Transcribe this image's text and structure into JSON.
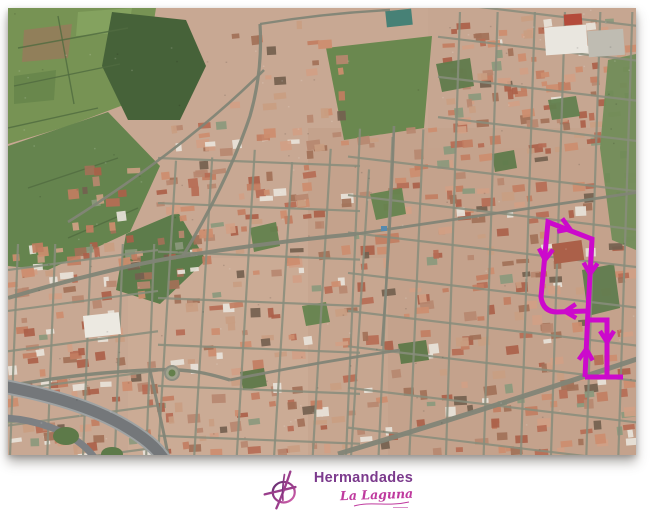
{
  "page": {
    "background": "#ffffff"
  },
  "map": {
    "name": "la-laguna-aerial-map",
    "type": "satellite",
    "palette": {
      "base": "#c7a691",
      "street": "#848a79",
      "major_road": "#7c8173",
      "highway_inner": "#6e7276",
      "highway_outer": "#9aa0a2",
      "roof_tones": [
        "#b4674f",
        "#c07a5c",
        "#a85a43",
        "#cc8a6a",
        "#c89b7f",
        "#9e6b52",
        "#d09d82",
        "#b5836b"
      ],
      "roof_light": "#e8e4db",
      "roof_greenish": "#87967a",
      "roof_dark": "#6e5a4a"
    },
    "greens": [
      {
        "points": "0,0 148,0 140,50 118,96 60,118 0,136",
        "fill": "#71904e"
      },
      {
        "points": "70,4 124,0 120,24 68,28",
        "fill": "#7fa05a"
      },
      {
        "points": "16,22 64,16 60,50 14,54",
        "fill": "#8d7b55"
      },
      {
        "points": "6,68 48,62 46,92 6,96",
        "fill": "#628346"
      },
      {
        "points": "104,4 178,12 198,58 172,112 120,112 94,58",
        "fill": "#3e5c32"
      },
      {
        "points": "0,138 100,104 152,158 122,224 40,262 0,258",
        "fill": "#5e8048"
      },
      {
        "points": "118,226 170,204 198,252 152,296 108,282",
        "fill": "#567845"
      },
      {
        "points": "318,40 424,28 416,120 336,132",
        "fill": "#648449"
      }
    ],
    "parks": [
      {
        "points": "600,52 628,46 628,242 604,232 592,140",
        "fill": "#6b8a54"
      },
      {
        "points": "574,262 606,256 612,300 580,308",
        "fill": "#587849"
      },
      {
        "points": "362,186 394,180 398,206 368,212",
        "fill": "#5f8049"
      },
      {
        "points": "428,56 462,50 466,78 434,84",
        "fill": "#587746"
      },
      {
        "points": "540,92 568,88 572,108 544,112",
        "fill": "#5c7c4a"
      },
      {
        "points": "294,298 318,294 322,314 298,318",
        "fill": "#5f8049"
      },
      {
        "points": "390,336 418,332 421,352 393,356",
        "fill": "#567442"
      },
      {
        "points": "232,364 256,360 259,378 235,382",
        "fill": "#567442"
      },
      {
        "points": "484,146 506,142 509,160 487,164",
        "fill": "#587746"
      },
      {
        "points": "242,220 268,214 272,238 246,244",
        "fill": "#5c7c48"
      }
    ],
    "roads": [
      {
        "d": "M0,290 C60,272 125,256 175,248 C245,237 305,230 348,226",
        "w": 4
      },
      {
        "d": "M175,248 C205,198 228,150 242,108 C250,80 254,48 252,16",
        "w": 3.2
      },
      {
        "d": "M330,446 C430,416 530,384 632,350",
        "w": 5
      },
      {
        "d": "M348,226 C430,214 520,200 632,184",
        "w": 2.8
      },
      {
        "d": "M252,16 C300,8 340,4 382,2",
        "w": 2.4
      },
      {
        "d": "M0,378 C44,370 92,364 142,362 C182,360 202,366 222,372",
        "w": 3.4
      },
      {
        "d": "M222,372 C290,358 340,350 392,342",
        "w": 2.8
      },
      {
        "d": "M386,118 C384,180 380,258 374,338",
        "w": 2.6
      },
      {
        "d": "M60,214 C130,170 200,118 256,62",
        "w": 2.6
      },
      {
        "d": "M142,362 C150,400 156,424 160,447",
        "w": 3
      }
    ],
    "highway": {
      "main": "M-6,378 C36,386 84,398 120,420 C140,432 154,444 162,462",
      "ramp": "M-2,410 C28,412 58,422 78,440 C88,450 93,458 95,470",
      "infields": [
        {
          "cx": 58,
          "cy": 428,
          "rx": 13,
          "ry": 9
        },
        {
          "cx": 104,
          "cy": 446,
          "rx": 11,
          "ry": 7
        }
      ]
    },
    "roundabout": {
      "cx": 164,
      "cy": 365,
      "r": 7
    },
    "landmarks": [
      {
        "name": "warehouse",
        "x": 537,
        "y": 18,
        "w": 42,
        "h": 28,
        "fill": "#e9e7e1",
        "rot": -4
      },
      {
        "name": "warehouse-yard",
        "x": 580,
        "y": 22,
        "w": 36,
        "h": 26,
        "fill": "#bdbbb2",
        "rot": -4
      },
      {
        "name": "white-building",
        "x": 76,
        "y": 306,
        "w": 36,
        "h": 22,
        "fill": "#edeae3",
        "rot": -6
      },
      {
        "name": "sports-court",
        "x": 378,
        "y": 2,
        "w": 26,
        "h": 16,
        "fill": "#3f7d72",
        "rot": -6
      },
      {
        "name": "pool",
        "x": 373,
        "y": 218,
        "w": 6,
        "h": 5,
        "fill": "#4f86ad",
        "rot": 0
      },
      {
        "name": "red-roof-building",
        "x": 556,
        "y": 6,
        "w": 18,
        "h": 11,
        "fill": "#b24434",
        "rot": -4
      },
      {
        "name": "convent-block",
        "x": 545,
        "y": 234,
        "w": 30,
        "h": 20,
        "fill": "#a85a43",
        "rot": -8
      }
    ]
  },
  "route": {
    "name": "procession-route",
    "color": "#cc09cc",
    "width": 5,
    "arrow_width": 4.5,
    "paths": [
      "M540,214 L584,231 L580,303 L549,304 Q535,304 533,289 Z",
      "M580,303 L577,369",
      "M579,312 L599,312 L599,369",
      "M577,369 L615,369"
    ],
    "arrows": [
      {
        "x": 562,
        "y": 221,
        "angle": 21
      },
      {
        "x": 582,
        "y": 266,
        "angle": 93
      },
      {
        "x": 537,
        "y": 252,
        "angle": 95
      },
      {
        "x": 557,
        "y": 303.5,
        "angle": 178
      },
      {
        "x": 578.3,
        "y": 341,
        "angle": -87
      },
      {
        "x": 599,
        "y": 334,
        "angle": 90
      }
    ]
  },
  "logo": {
    "title": "Hermandades",
    "subtitle": "La Laguna",
    "title_color": "#7b3a8c",
    "subtitle_color": "#bf3a9e",
    "icon_gradient": [
      "#5f2d6e",
      "#a0408f",
      "#d867b0"
    ]
  }
}
